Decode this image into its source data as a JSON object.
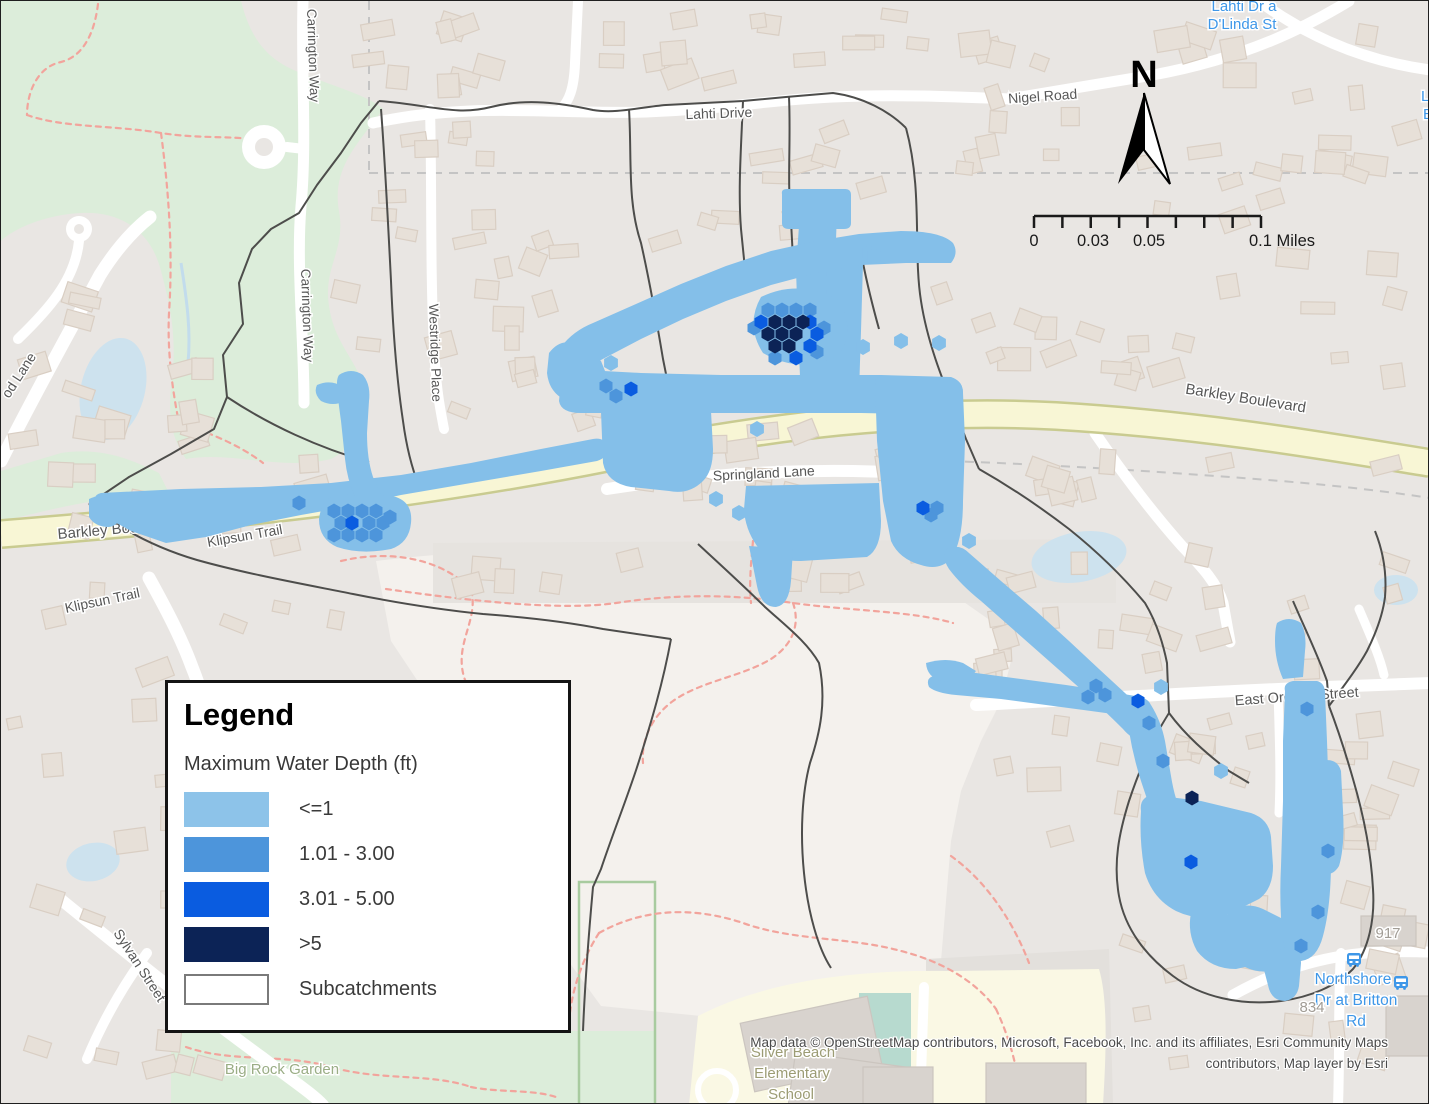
{
  "legend": {
    "title": "Legend",
    "subtitle": "Maximum Water Depth (ft)",
    "items": [
      {
        "label": "<=1",
        "color": "#8DC3E9"
      },
      {
        "label": "1.01 - 3.00",
        "color": "#4D95DB"
      },
      {
        "label": "3.01 - 5.00",
        "color": "#0A5CE0"
      },
      {
        "label": ">5",
        "color": "#0C2356"
      },
      {
        "label": "Subcatchments",
        "color": "#FFFFFF",
        "border": "#7a7a7a",
        "type": "outline"
      }
    ]
  },
  "north_arrow": {
    "label": "N"
  },
  "scale_bar": {
    "x1": 1033,
    "x2": 1260,
    "y": 215,
    "tick_count": 9,
    "labels": [
      {
        "text": "0",
        "x": 1033,
        "anchor": "middle"
      },
      {
        "text": "0.03",
        "x": 1092,
        "anchor": "middle"
      },
      {
        "text": "0.05",
        "x": 1148,
        "anchor": "middle"
      },
      {
        "text": "0.1 Miles",
        "x": 1248,
        "anchor": "start"
      }
    ]
  },
  "attribution": {
    "line1": "Map data © OpenStreetMap contributors, Microsoft, Facebook, Inc. and its affiliates, Esri Community Maps",
    "line2": "contributors, Map layer by Esri"
  },
  "colors": {
    "bg": "#E9E6E3",
    "pale": "#F4F1ED",
    "park": "#DCEDDA",
    "garden_border": "#A8CB9F",
    "school": "#FAF8E4",
    "teal_field": "#B7DACF",
    "water": "#CDE2EE",
    "stream": "#C2DCEC",
    "road_yellow": "#F8F6D5",
    "road_casing": "#C9CB90",
    "street": "#FFFFFF",
    "building": "#E7E0D8",
    "building_stroke": "#D9CEC3",
    "big_building": "#D8D3CE",
    "subcatchment": "#4D4D4B",
    "trail": "#F2A49C",
    "admin": "#C4C4C4",
    "label": "#575757",
    "halo": "#FFFFFF",
    "depth_lt1": "#84BFE9",
    "depth_1_3": "#4D95DB",
    "depth_3_5": "#0A5CE0",
    "depth_gt5": "#0C2356",
    "poi_green": "#9AAD85",
    "poi_school": "#9C9C74",
    "poi_blue": "#3E97E8",
    "housenum": "#A19C95",
    "darker_zone": "#E3E0DC",
    "gray_strip": "#E6E3DF"
  },
  "map": {
    "pale_area": "M375,560 Q500,545 640,548 L760,548 L830,562 L900,578 L950,592 L990,620 L1010,660 L1000,700 L980,740 L960,790 L950,840 L945,900 L940,960 L920,985 L700,1015 L600,1005 L560,950 L520,840 L450,730 L390,640 Z",
    "darker_zone": "M925,958 L1108,948 L1112,1104 L925,1104 Z",
    "gray_strip": "M432,542 L1115,538 L1115,602 L432,602 Z",
    "parks": [
      "M0,0 L240,0 C250,40 268,60 300,72 C340,88 368,95 382,108 C360,140 330,165 338,210 C345,250 322,265 328,305 C334,348 362,362 366,402 C360,430 350,448 330,458 C280,470 230,450 185,458 C165,430 168,400 172,368 C175,330 168,300 160,270 C150,230 120,210 80,212 C40,214 10,230 0,240 Z",
      "M0,470 L60,452 C100,446 130,458 158,472 L168,492 L95,500 C60,505 25,515 0,520 Z",
      "M170,1030 L655,1030 L655,1104 L170,1104 Z"
    ],
    "garden_border": {
      "x": 578,
      "y": 881,
      "w": 76,
      "h": 223
    },
    "school_area": "M688,1104 L697,1015 C760,982 850,968 950,970 L1098,968 C1106,995 1106,1040 1102,1104 Z",
    "teal_field": {
      "x": 858,
      "y": 992,
      "w": 52,
      "h": 76
    },
    "track_ring": {
      "cx": 716,
      "cy": 1089,
      "r": 19
    },
    "admin_lines": [
      "M368,0 L368,172",
      "M368,172 L1429,172",
      "M948,460 C1060,464 1180,472 1280,480 C1340,485 1390,491 1429,497"
    ],
    "trails": [
      "M97,3 C93,36 80,56 60,61 C36,66 26,92 26,114",
      "M26,114 C62,127 112,124 160,132 C205,139 240,133 268,142",
      "M160,132 C168,192 172,252 168,312 C166,352 172,392 178,422",
      "M178,422 C210,432 240,445 262,462",
      "M340,560 C390,548 440,558 470,588 C478,618 455,640 462,672 C468,700 492,700 498,728 C502,752 488,768 490,790",
      "M385,588 C470,600 560,610 615,602 C680,592 740,594 792,602 C850,610 912,610 952,622",
      "M752,540 C750,562 748,582 750,602",
      "M792,602 C800,625 790,645 770,658 C740,676 700,680 672,700 C650,716 640,740 642,762",
      "M598,932 C648,904 700,908 742,922 C792,940 850,936 900,950 C940,960 975,980 995,1008",
      "M598,932 C580,960 570,992 568,1022",
      "M995,1008 C1010,1040 1018,1072 1020,1104",
      "M185,1046 C230,1062 282,1052 330,1066 C378,1080 430,1072 470,1086",
      "M470,1086 C500,1092 530,1088 555,1096",
      "M950,855 C985,880 1012,920 1028,962"
    ],
    "ponds": [
      {
        "cx": 112,
        "cy": 388,
        "rx": 32,
        "ry": 52,
        "rot": 14
      },
      {
        "cx": 1078,
        "cy": 556,
        "rx": 48,
        "ry": 25,
        "rot": -10
      },
      {
        "cx": 1395,
        "cy": 589,
        "rx": 22,
        "ry": 15,
        "rot": 0
      },
      {
        "cx": 92,
        "cy": 861,
        "rx": 27,
        "ry": 19,
        "rot": -12
      },
      {
        "cx": 97,
        "cy": 502,
        "rx": 9,
        "ry": 5,
        "rot": 0
      },
      {
        "cx": 57,
        "cy": 519,
        "rx": 7,
        "ry": 4,
        "rot": 20
      }
    ],
    "stream": "M180,262 C186,300 190,330 187,362",
    "streets": [
      {
        "d": "M372,122 C470,100 560,114 645,111 C725,108 765,99 832,96 C900,93 960,96 1008,98 L1152,74 C1245,57 1305,26 1348,0",
        "w": 11
      },
      {
        "d": "M1258,0 C1318,44 1378,62 1429,69",
        "w": 11
      },
      {
        "d": "M302,0 C300,70 306,140 300,205 C295,265 303,335 303,402",
        "w": 11
      },
      {
        "d": "M286,146 L303,148",
        "w": 10
      },
      {
        "d": "M429,108 C431,180 429,270 433,345 C435,390 440,412 443,428",
        "w": 10
      },
      {
        "d": "M577,0 L574,62 C573,88 568,100 560,108",
        "w": 10
      },
      {
        "d": "M606,488 C700,473 780,469 852,470 C902,471 936,473 953,475",
        "w": 12
      },
      {
        "d": "M975,704 C1090,698 1200,691 1300,687 C1352,685 1396,683 1429,682",
        "w": 12
      },
      {
        "d": "M1094,432 C1120,470 1150,510 1181,545 C1202,567 1216,582 1222,602 L1229,641",
        "w": 11
      },
      {
        "d": "M1232,994 C1282,966 1330,953 1382,951 C1402,950 1416,951 1429,951",
        "w": 11
      },
      {
        "d": "M1277,689 C1278,730 1280,770 1278,812",
        "w": 9
      },
      {
        "d": "M1358,608 C1370,636 1379,656 1383,674",
        "w": 9
      },
      {
        "d": "M1340,952 C1337,1000 1339,1052 1337,1104",
        "w": 10
      },
      {
        "d": "M58,897 C128,954 200,1012 262,1057 C292,1080 312,1093 322,1104",
        "w": 12
      },
      {
        "d": "M146,952 C121,986 101,1022 86,1058",
        "w": 10
      },
      {
        "d": "M148,577 C164,606 180,636 191,666 C199,686 204,702 205,716",
        "w": 13
      },
      {
        "d": "M0,460 C34,392 68,332 99,274 C114,250 130,231 149,216",
        "w": 13
      },
      {
        "d": "M78,240 C74,280 46,310 17,338",
        "w": 10
      },
      {
        "d": "M923,986 L919,1104",
        "w": 10
      }
    ],
    "culdesacs": [
      {
        "cx": 263,
        "cy": 146,
        "r": 22,
        "hole": 9
      },
      {
        "cx": 78,
        "cy": 228,
        "r": 13,
        "hole": 5
      }
    ],
    "yellow_road": {
      "d": "M0,533 C240,514 430,492 610,456 C770,425 910,407 1055,415 C1205,424 1330,446 1429,462",
      "w": 25,
      "casing": 30
    },
    "subcatchments": [
      "M88,503 L128,476 L170,453 L213,428 L226,396 L222,354 L242,323 L238,282 L251,248 L270,228 L298,212 L316,184 L340,152 L360,122 L378,100",
      "M378,100 C430,104 455,115 490,106 C525,97 560,102 592,109 C615,113 640,106 665,104 L742,100 L785,96 L832,92 C862,96 888,110 905,127",
      "M905,127 C922,190 912,250 920,300 C928,352 950,398 965,438 L978,468",
      "M628,108 C631,158 626,200 640,242 C649,282 656,322 662,358 L668,388",
      "M742,100 C740,148 737,190 740,228 L744,268",
      "M788,96 C790,140 786,180 790,220 L792,258",
      "M862,262 C868,292 873,310 878,328",
      "M88,503 C116,526 152,546 196,559 C246,573 302,583 352,593 C402,603 442,609 482,613 C522,616 562,620 602,628 C635,633 655,636 670,638",
      "M226,396 C268,424 318,447 368,461",
      "M670,638 C662,682 650,722 638,760 C628,792 612,832 600,868 L592,886 C588,930 584,980 582,1030",
      "M697,543 C722,566 744,586 764,606 C786,626 806,641 818,662 C826,700 819,732 809,762 C801,792 799,832 803,872 C807,912 817,947 830,967",
      "M978,468 C1008,485 1038,505 1068,528 C1098,552 1124,578 1144,602 C1156,622 1162,642 1166,662 L1168,712 C1185,735 1205,752 1228,770 L1248,782",
      "M1168,712 C1150,740 1138,770 1128,800 C1118,832 1112,862 1118,895 C1124,928 1145,955 1172,975 C1200,996 1240,1005 1280,1000 C1310,996 1335,985 1352,968 C1368,948 1374,918 1372,888 C1370,850 1362,812 1352,778 C1344,750 1336,726 1328,705",
      "M1328,705 C1342,686 1356,668 1366,650 C1376,630 1382,612 1384,596 C1386,572 1382,550 1374,530",
      "M1292,600 C1304,628 1316,652 1326,680 L1328,705",
      "M380,108 C384,160 387,220 390,280 C392,330 396,380 402,420 C406,450 412,470 418,485"
    ],
    "flood_blobs": [
      "M781,193 Q780,188 786,188 L844,188 Q850,188 850,194 L850,222 Q850,228 843,228 L788,228 Q781,228 781,222 Z",
      "M799,210 L836,210 L834,268 L836,330 L834,398 L800,398 L797,330 L795,268 Z",
      "M826,258 L862,262 L860,330 L858,392 L824,392 L824,330 Z",
      "M560,346 Q572,330 592,322 L635,303 L680,283 L725,265 L770,250 L815,240 L858,233 L900,230 Q940,230 952,242 Q958,252 950,262 L905,262 L860,264 L815,272 L770,284 L725,300 L682,318 L640,338 L598,360 Q578,372 566,368 Q552,360 560,346 Z",
      "M760,296 Q797,278 836,298 Q856,326 838,354 Q800,374 762,352 Q744,324 760,296 Z",
      "M560,380 Q556,372 566,368 L640,372 L720,374 L800,374 L880,374 L950,376 Q962,380 962,392 L960,408 Q958,414 948,414 L860,412 L760,412 L660,412 L580,412 Q560,412 558,400 Z",
      "M600,410 L710,410 L712,448 Q712,470 702,480 Q688,494 668,490 L630,486 Q606,482 602,462 Z",
      "M874,378 L952,378 Q962,380 962,392 L964,440 L962,500 Q962,540 950,558 Q938,570 920,564 Q898,558 890,540 L882,500 L876,440 Z",
      "M745,485 L878,482 L880,520 Q880,548 866,556 L800,560 Q768,560 756,545 Q744,528 743,508 Z",
      "M748,545 L792,548 L790,580 Q788,604 775,606 Q760,606 756,585 Z",
      "M95,500 Q92,494 100,492 L180,488 L260,486 L330,482 L400,474 L470,462 L540,448 L592,438 Q604,436 606,446 Q608,456 596,460 L540,470 L470,482 L400,494 L345,506 L300,514 L250,524 L205,536 L165,542 L130,530 L105,516 Q94,510 95,500 Z",
      "M330,496 Q365,490 395,496 Q412,502 410,522 Q408,542 390,548 Q360,554 336,546 Q318,538 318,518 Q320,502 330,496 Z",
      "M88,498 Q100,492 110,498 L118,512 Q120,524 108,526 Q94,526 88,516 Z",
      "M338,374 Q350,366 362,374 Q370,384 368,400 L366,432 Q366,458 372,476 L380,494 Q382,504 372,506 Q360,508 354,496 Q346,478 344,458 L340,420 Q336,392 336,382 Q336,377 338,374 Z",
      "M316,384 Q330,378 342,386 L344,400 Q332,406 320,400 Q312,392 316,384 Z",
      "M548,352 Q560,336 576,344 L600,360 L608,380 L600,402 L566,400 Q548,392 546,372 Z",
      "M946,548 Q958,542 968,552 L1000,580 L1035,610 L1068,640 L1098,668 L1124,692 Q1140,706 1148,722 Q1152,734 1142,738 Q1132,740 1122,728 Q1104,710 1082,690 L1048,660 L1014,630 L980,600 Q960,584 948,568 Q940,556 946,548 Z",
      "M930,676 Q950,668 975,672 L1020,678 L1065,684 L1105,690 L1140,696 Q1152,700 1150,710 Q1148,718 1134,716 L1090,710 L1045,704 L1000,698 L955,694 Q935,692 928,686 Q925,679 930,676 Z",
      "M925,662 Q945,656 962,662 L975,670 L965,682 L940,680 Q926,676 925,662 Z",
      "M1130,700 Q1142,694 1150,704 Q1160,720 1164,740 L1170,775 Q1174,800 1182,815 L1196,835 Q1186,846 1172,838 Q1158,828 1150,810 L1140,780 Q1132,755 1128,730 Q1124,708 1130,700 Z",
      "M1140,810 Q1138,796 1152,794 L1200,800 L1250,812 Q1268,818 1270,836 L1272,865 Q1272,888 1258,898 L1230,912 Q1200,922 1175,910 Q1152,898 1144,872 Q1138,840 1140,810 Z",
      "M1200,900 L1240,920 L1262,940 Q1270,952 1262,962 L1235,968 Q1210,968 1196,950 Q1186,932 1190,912 Z",
      "M1228,910 Q1245,900 1262,908 L1290,922 Q1300,930 1298,945 Q1296,962 1280,968 Q1260,974 1244,966 Q1228,956 1224,938 Q1222,920 1228,910 Z",
      "M1262,950 L1290,948 Q1300,950 1300,962 L1298,985 Q1296,998 1284,1000 Q1272,1000 1268,988 L1262,965 Z",
      "M1284,690 Q1282,682 1292,680 L1316,680 Q1324,682 1324,692 L1326,740 L1328,800 L1330,860 Q1330,905 1322,935 Q1316,958 1300,960 Q1286,960 1282,940 Q1278,905 1280,865 L1282,800 L1282,740 Z",
      "M1320,760 Q1336,756 1340,770 L1342,810 Q1344,845 1338,865 Q1330,878 1318,870 L1316,830 L1316,790 Z",
      "M1276,622 Q1288,614 1300,622 Q1306,634 1304,650 L1302,676 L1282,678 Q1274,660 1274,640 Q1274,628 1276,622 Z"
    ],
    "hex_light": [
      [
        868,
        252
      ],
      [
        873,
        255
      ],
      [
        900,
        340
      ],
      [
        938,
        342
      ],
      [
        862,
        346
      ],
      [
        610,
        362
      ],
      [
        756,
        428
      ],
      [
        968,
        540
      ],
      [
        1160,
        686
      ],
      [
        1220,
        770
      ],
      [
        715,
        498
      ],
      [
        738,
        512
      ]
    ],
    "hex_medium": [
      [
        767,
        309
      ],
      [
        781,
        309
      ],
      [
        795,
        309
      ],
      [
        809,
        309
      ],
      [
        753,
        327
      ],
      [
        823,
        327
      ],
      [
        816,
        351
      ],
      [
        774,
        357
      ],
      [
        333,
        510
      ],
      [
        347,
        510
      ],
      [
        361,
        510
      ],
      [
        375,
        510
      ],
      [
        340,
        522
      ],
      [
        368,
        522
      ],
      [
        382,
        522
      ],
      [
        333,
        534
      ],
      [
        347,
        534
      ],
      [
        361,
        534
      ],
      [
        375,
        534
      ],
      [
        389,
        516
      ],
      [
        1306,
        708
      ],
      [
        1327,
        850
      ],
      [
        1317,
        911
      ],
      [
        1300,
        945
      ],
      [
        1095,
        685
      ],
      [
        1104,
        694
      ],
      [
        1087,
        696
      ],
      [
        930,
        514
      ],
      [
        936,
        507
      ],
      [
        1148,
        722
      ],
      [
        1162,
        760
      ],
      [
        615,
        395
      ],
      [
        605,
        385
      ],
      [
        298,
        502
      ]
    ],
    "hex_bright": [
      [
        809,
        321
      ],
      [
        816,
        333
      ],
      [
        809,
        345
      ],
      [
        795,
        357
      ],
      [
        760,
        321
      ],
      [
        922,
        507
      ],
      [
        1137,
        700
      ],
      [
        1190,
        861
      ],
      [
        630,
        388
      ],
      [
        351,
        522
      ]
    ],
    "hex_navy": [
      [
        788,
        321
      ],
      [
        774,
        321
      ],
      [
        802,
        321
      ],
      [
        781,
        333
      ],
      [
        795,
        333
      ],
      [
        767,
        333
      ],
      [
        788,
        345
      ],
      [
        774,
        345
      ],
      [
        1191,
        797
      ]
    ],
    "street_labels": [
      {
        "t": "Lahti Drive",
        "x": 718,
        "y": 117,
        "r": -2,
        "s": 14
      },
      {
        "t": "Nigel Road",
        "x": 1042,
        "y": 100,
        "r": -4,
        "s": 14
      },
      {
        "t": "Carrington Way",
        "x": 306,
        "y": 8,
        "r": 88,
        "s": 13.5,
        "anchor": "start"
      },
      {
        "t": "Carrington Way",
        "x": 300,
        "y": 268,
        "r": 88,
        "s": 13.5,
        "anchor": "start"
      },
      {
        "t": "Westridge Place",
        "x": 428,
        "y": 303,
        "r": 88,
        "s": 13.5,
        "anchor": "start"
      },
      {
        "t": "Barkley Boulevard",
        "x": 1244,
        "y": 402,
        "r": 9,
        "s": 15
      },
      {
        "t": "Barkley Boulevard",
        "x": 57,
        "y": 538,
        "r": -5,
        "s": 15,
        "anchor": "start"
      },
      {
        "t": "ard",
        "x": 727,
        "y": 400,
        "r": -2,
        "s": 14
      },
      {
        "t": "Springland Lane",
        "x": 763,
        "y": 477,
        "r": -3,
        "s": 14
      },
      {
        "t": "Klipsun Trail",
        "x": 65,
        "y": 612,
        "r": -12,
        "s": 14,
        "anchor": "start"
      },
      {
        "t": "Klipsun Trail",
        "x": 207,
        "y": 546,
        "r": -10,
        "s": 14,
        "anchor": "start"
      },
      {
        "t": "East Oregon Street",
        "x": 1296,
        "y": 700,
        "r": -4,
        "s": 14.5
      },
      {
        "t": "Sylvan Street",
        "x": 112,
        "y": 932,
        "r": 57,
        "s": 14,
        "anchor": "start"
      },
      {
        "t": "od Lane",
        "x": 8,
        "y": 398,
        "r": -57,
        "s": 14,
        "anchor": "start"
      }
    ],
    "poi_labels": [
      {
        "t": "Big Rock Garden",
        "x": 281,
        "y": 1073,
        "s": 15,
        "c": "poi_green"
      },
      {
        "t": "Silver Beach",
        "x": 792,
        "y": 1056,
        "s": 15,
        "c": "poi_school"
      },
      {
        "t": "Elementary",
        "x": 791,
        "y": 1077,
        "s": 15,
        "c": "poi_school"
      },
      {
        "t": "School",
        "x": 790,
        "y": 1098,
        "s": 15,
        "c": "poi_school"
      },
      {
        "t": "Northshore",
        "x": 1352,
        "y": 983,
        "s": 15.5,
        "c": "poi_blue"
      },
      {
        "t": "Dr at Britton",
        "x": 1355,
        "y": 1004,
        "s": 15.5,
        "c": "poi_blue"
      },
      {
        "t": "Rd",
        "x": 1355,
        "y": 1025,
        "s": 15.5,
        "c": "poi_blue"
      },
      {
        "t": "917",
        "x": 1387,
        "y": 937,
        "s": 15,
        "c": "housenum"
      },
      {
        "t": "834",
        "x": 1311,
        "y": 1011,
        "s": 15,
        "c": "housenum"
      },
      {
        "t": "Lahti Dr a",
        "x": 1243,
        "y": 10,
        "s": 15,
        "c": "poi_blue"
      },
      {
        "t": "D'Linda St",
        "x": 1241,
        "y": 28,
        "s": 15,
        "c": "poi_blue"
      },
      {
        "t": "La",
        "x": 1420,
        "y": 100,
        "s": 15,
        "c": "poi_blue",
        "anchor": "start"
      },
      {
        "t": "B",
        "x": 1422,
        "y": 118,
        "s": 15,
        "c": "poi_blue",
        "anchor": "start"
      }
    ],
    "bus_stops": [
      {
        "x": 1353,
        "y": 959
      },
      {
        "x": 1400,
        "y": 982
      }
    ]
  }
}
